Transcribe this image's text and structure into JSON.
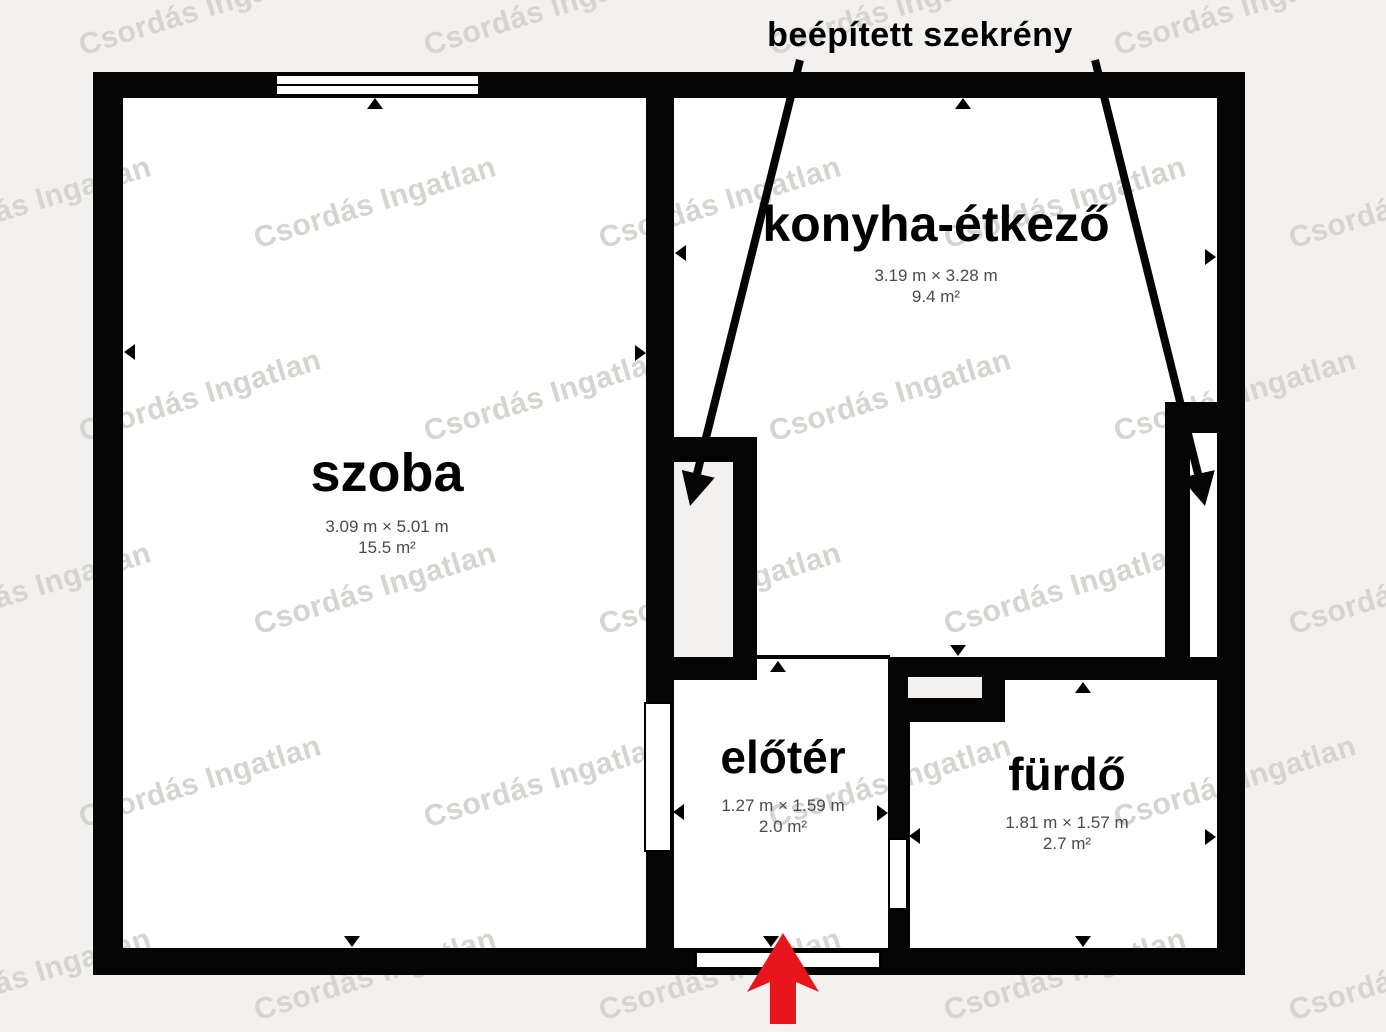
{
  "title": "beépített szekrény",
  "watermark": {
    "text": "Csordás Ingatlan"
  },
  "rooms": {
    "szoba": {
      "name": "szoba",
      "dimensions": "3.09 m × 5.01 m",
      "area": "15.5 m²"
    },
    "konyha": {
      "name": "konyha-étkező",
      "dimensions": "3.19 m × 3.28 m",
      "area": "9.4 m²"
    },
    "eloter": {
      "name": "előtér",
      "dimensions": "1.27 m × 1.59 m",
      "area": "2.0 m²"
    },
    "furdo": {
      "name": "fürdő",
      "dimensions": "1.81 m × 1.57 m",
      "area": "2.7 m²"
    }
  },
  "colors": {
    "wall": "#050505",
    "room_fill": "#ffffff",
    "background": "#f2f1ef",
    "entrance_arrow_red": "#e8151c",
    "dimension_text": "#4a4a4a",
    "watermark_gray": "#d6d4d1"
  }
}
